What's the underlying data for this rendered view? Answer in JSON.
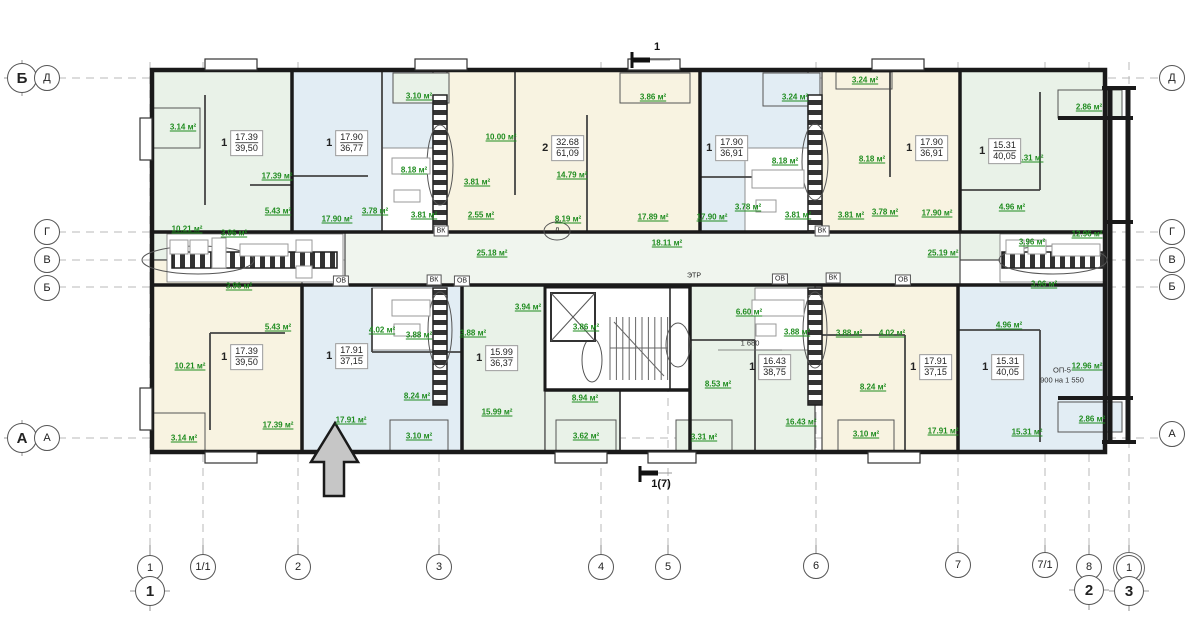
{
  "plan": {
    "area_unit": "м²",
    "colors": {
      "room_green": "#e9f2e8",
      "room_blue": "#e2edf4",
      "room_cream": "#f8f3e1",
      "corridor": "#f0f5ee",
      "area_text": "#1f8c1f",
      "wall": "#1a1a1a",
      "grid": "#b8b8b8",
      "arrow_fill": "#c6c6c6"
    },
    "axis_left": [
      {
        "label": "Б",
        "x": 22,
        "y": 78,
        "type": "large"
      },
      {
        "label": "Д",
        "x": 47,
        "y": 78,
        "type": "small"
      },
      {
        "label": "Г",
        "x": 47,
        "y": 232,
        "type": "small"
      },
      {
        "label": "В",
        "x": 47,
        "y": 260,
        "type": "small"
      },
      {
        "label": "Б",
        "x": 47,
        "y": 288,
        "type": "small"
      },
      {
        "label": "А",
        "x": 22,
        "y": 438,
        "type": "large"
      },
      {
        "label": "А",
        "x": 47,
        "y": 438,
        "type": "small"
      }
    ],
    "axis_right": [
      {
        "label": "Д",
        "x": 1172,
        "y": 78,
        "type": "small"
      },
      {
        "label": "Г",
        "x": 1172,
        "y": 232,
        "type": "small"
      },
      {
        "label": "В",
        "x": 1172,
        "y": 260,
        "type": "small"
      },
      {
        "label": "Б",
        "x": 1172,
        "y": 287,
        "type": "small"
      },
      {
        "label": "А",
        "x": 1172,
        "y": 434,
        "type": "small"
      }
    ],
    "axis_bottom": [
      {
        "label": "1",
        "x": 150,
        "y": 568,
        "type": "small"
      },
      {
        "label": "1",
        "x": 150,
        "y": 591,
        "type": "large"
      },
      {
        "label": "1/1",
        "x": 203,
        "y": 567,
        "type": "small"
      },
      {
        "label": "2",
        "x": 298,
        "y": 567,
        "type": "small"
      },
      {
        "label": "3",
        "x": 439,
        "y": 567,
        "type": "small"
      },
      {
        "label": "4",
        "x": 601,
        "y": 567,
        "type": "small"
      },
      {
        "label": "5",
        "x": 668,
        "y": 567,
        "type": "small"
      },
      {
        "label": "6",
        "x": 816,
        "y": 566,
        "type": "small"
      },
      {
        "label": "7",
        "x": 958,
        "y": 565,
        "type": "small"
      },
      {
        "label": "7/1",
        "x": 1045,
        "y": 565,
        "type": "small"
      },
      {
        "label": "8",
        "x": 1089,
        "y": 567,
        "type": "small"
      },
      {
        "label": "2",
        "x": 1089,
        "y": 590,
        "type": "large"
      },
      {
        "label": "1",
        "x": 1129,
        "y": 568,
        "type": "double"
      },
      {
        "label": "3",
        "x": 1129,
        "y": 591,
        "type": "large"
      }
    ],
    "section_markers": [
      {
        "label": "1",
        "x": 657,
        "y": 47
      },
      {
        "label": "1(7)",
        "x": 661,
        "y": 484
      }
    ],
    "apartments": [
      {
        "num": "1",
        "living": "17.39",
        "total": "39,50",
        "x": 242,
        "y": 143
      },
      {
        "num": "1",
        "living": "17.90",
        "total": "36,77",
        "x": 347,
        "y": 143
      },
      {
        "num": "2",
        "living": "32.68",
        "total": "61,09",
        "x": 563,
        "y": 148
      },
      {
        "num": "1",
        "living": "17.90",
        "total": "36,91",
        "x": 727,
        "y": 148
      },
      {
        "num": "1",
        "living": "17.90",
        "total": "36,91",
        "x": 927,
        "y": 148
      },
      {
        "num": "1",
        "living": "15.31",
        "total": "40,05",
        "x": 1000,
        "y": 151
      },
      {
        "num": "1",
        "living": "17.39",
        "total": "39,50",
        "x": 242,
        "y": 357
      },
      {
        "num": "1",
        "living": "17.91",
        "total": "37,15",
        "x": 347,
        "y": 356
      },
      {
        "num": "1",
        "living": "15.99",
        "total": "36,37",
        "x": 497,
        "y": 358
      },
      {
        "num": "1",
        "living": "16.43",
        "total": "38,75",
        "x": 770,
        "y": 367
      },
      {
        "num": "1",
        "living": "17.91",
        "total": "37,15",
        "x": 931,
        "y": 367
      },
      {
        "num": "1",
        "living": "15.31",
        "total": "40,05",
        "x": 1003,
        "y": 367
      }
    ],
    "room_areas": [
      {
        "v": "3.14",
        "x": 183,
        "y": 127
      },
      {
        "v": "17.39",
        "x": 277,
        "y": 176
      },
      {
        "v": "5.43",
        "x": 278,
        "y": 211
      },
      {
        "v": "10.21",
        "x": 187,
        "y": 229
      },
      {
        "v": "3.96",
        "x": 234,
        "y": 233
      },
      {
        "v": "3.10",
        "x": 419,
        "y": 96
      },
      {
        "v": "8.18",
        "x": 414,
        "y": 170
      },
      {
        "v": "3.78",
        "x": 375,
        "y": 211
      },
      {
        "v": "3.81",
        "x": 424,
        "y": 215
      },
      {
        "v": "17.90",
        "x": 337,
        "y": 219
      },
      {
        "v": "2.55",
        "x": 481,
        "y": 215
      },
      {
        "v": "10.00",
        "x": 501,
        "y": 137
      },
      {
        "v": "3.86",
        "x": 653,
        "y": 97
      },
      {
        "v": "14.79",
        "x": 572,
        "y": 175
      },
      {
        "v": "3.81",
        "x": 477,
        "y": 182
      },
      {
        "v": "8.19",
        "x": 568,
        "y": 219
      },
      {
        "v": "17.89",
        "x": 653,
        "y": 217
      },
      {
        "v": "17.90",
        "x": 712,
        "y": 217
      },
      {
        "v": "25.18",
        "x": 492,
        "y": 253
      },
      {
        "v": "18.11",
        "x": 667,
        "y": 243
      },
      {
        "v": "3.24",
        "x": 795,
        "y": 97
      },
      {
        "v": "3.24",
        "x": 865,
        "y": 80
      },
      {
        "v": "8.18",
        "x": 785,
        "y": 161
      },
      {
        "v": "8.18",
        "x": 872,
        "y": 159
      },
      {
        "v": "3.78",
        "x": 748,
        "y": 207
      },
      {
        "v": "3.78",
        "x": 885,
        "y": 212
      },
      {
        "v": "3.81",
        "x": 798,
        "y": 215
      },
      {
        "v": "3.81",
        "x": 851,
        "y": 215
      },
      {
        "v": "17.90",
        "x": 937,
        "y": 213
      },
      {
        "v": "25.19",
        "x": 943,
        "y": 253
      },
      {
        "v": "2.86",
        "x": 1089,
        "y": 107
      },
      {
        "v": "15.31",
        "x": 1028,
        "y": 158
      },
      {
        "v": "4.96",
        "x": 1012,
        "y": 207
      },
      {
        "v": "3.96",
        "x": 1032,
        "y": 242
      },
      {
        "v": "12.96",
        "x": 1087,
        "y": 234
      },
      {
        "v": "3.96",
        "x": 239,
        "y": 286
      },
      {
        "v": "5.43",
        "x": 278,
        "y": 327
      },
      {
        "v": "10.21",
        "x": 190,
        "y": 366
      },
      {
        "v": "17.39",
        "x": 278,
        "y": 425
      },
      {
        "v": "3.14",
        "x": 184,
        "y": 438
      },
      {
        "v": "4.02",
        "x": 382,
        "y": 330
      },
      {
        "v": "3.88",
        "x": 419,
        "y": 335
      },
      {
        "v": "8.24",
        "x": 417,
        "y": 396
      },
      {
        "v": "17.91",
        "x": 351,
        "y": 420
      },
      {
        "v": "3.10",
        "x": 419,
        "y": 436
      },
      {
        "v": "3.94",
        "x": 528,
        "y": 307
      },
      {
        "v": "3.86",
        "x": 586,
        "y": 327
      },
      {
        "v": "3.88",
        "x": 473,
        "y": 333
      },
      {
        "v": "15.99",
        "x": 497,
        "y": 412
      },
      {
        "v": "8.94",
        "x": 585,
        "y": 398
      },
      {
        "v": "3.62",
        "x": 586,
        "y": 436
      },
      {
        "v": "8.53",
        "x": 718,
        "y": 384
      },
      {
        "v": "3.31",
        "x": 704,
        "y": 437
      },
      {
        "v": "6.60",
        "x": 749,
        "y": 312
      },
      {
        "v": "3.88",
        "x": 797,
        "y": 332
      },
      {
        "v": "3.88",
        "x": 849,
        "y": 333
      },
      {
        "v": "4.02",
        "x": 892,
        "y": 333
      },
      {
        "v": "8.24",
        "x": 873,
        "y": 387
      },
      {
        "v": "16.43",
        "x": 801,
        "y": 422
      },
      {
        "v": "3.10",
        "x": 866,
        "y": 434
      },
      {
        "v": "17.91",
        "x": 943,
        "y": 431
      },
      {
        "v": "3.96",
        "x": 1044,
        "y": 284
      },
      {
        "v": "4.96",
        "x": 1009,
        "y": 325
      },
      {
        "v": "12.96",
        "x": 1087,
        "y": 366
      },
      {
        "v": "2.86",
        "x": 1092,
        "y": 419
      },
      {
        "v": "15.31",
        "x": 1027,
        "y": 432
      }
    ],
    "service_tags": [
      {
        "t": "ВК",
        "s": "box",
        "x": 441,
        "y": 231
      },
      {
        "t": "ВК",
        "s": "box",
        "x": 822,
        "y": 231
      },
      {
        "t": "ВК",
        "s": "box",
        "x": 434,
        "y": 280
      },
      {
        "t": "ВК",
        "s": "box",
        "x": 833,
        "y": 278
      },
      {
        "t": "ОВ",
        "s": "box",
        "x": 341,
        "y": 281
      },
      {
        "t": "ОВ",
        "s": "box",
        "x": 462,
        "y": 281
      },
      {
        "t": "ОВ",
        "s": "box",
        "x": 780,
        "y": 279
      },
      {
        "t": "ОВ",
        "s": "box",
        "x": 903,
        "y": 280
      },
      {
        "t": "ЭТР",
        "s": "plain",
        "x": 694,
        "y": 276
      },
      {
        "t": "Л",
        "s": "plain",
        "x": 557,
        "y": 231
      }
    ],
    "notes": [
      {
        "t": "1 680",
        "x": 750,
        "y": 343
      },
      {
        "t": "ОП-5",
        "x": 1062,
        "y": 370
      },
      {
        "t": "900 на 1 550",
        "x": 1062,
        "y": 380
      }
    ]
  }
}
